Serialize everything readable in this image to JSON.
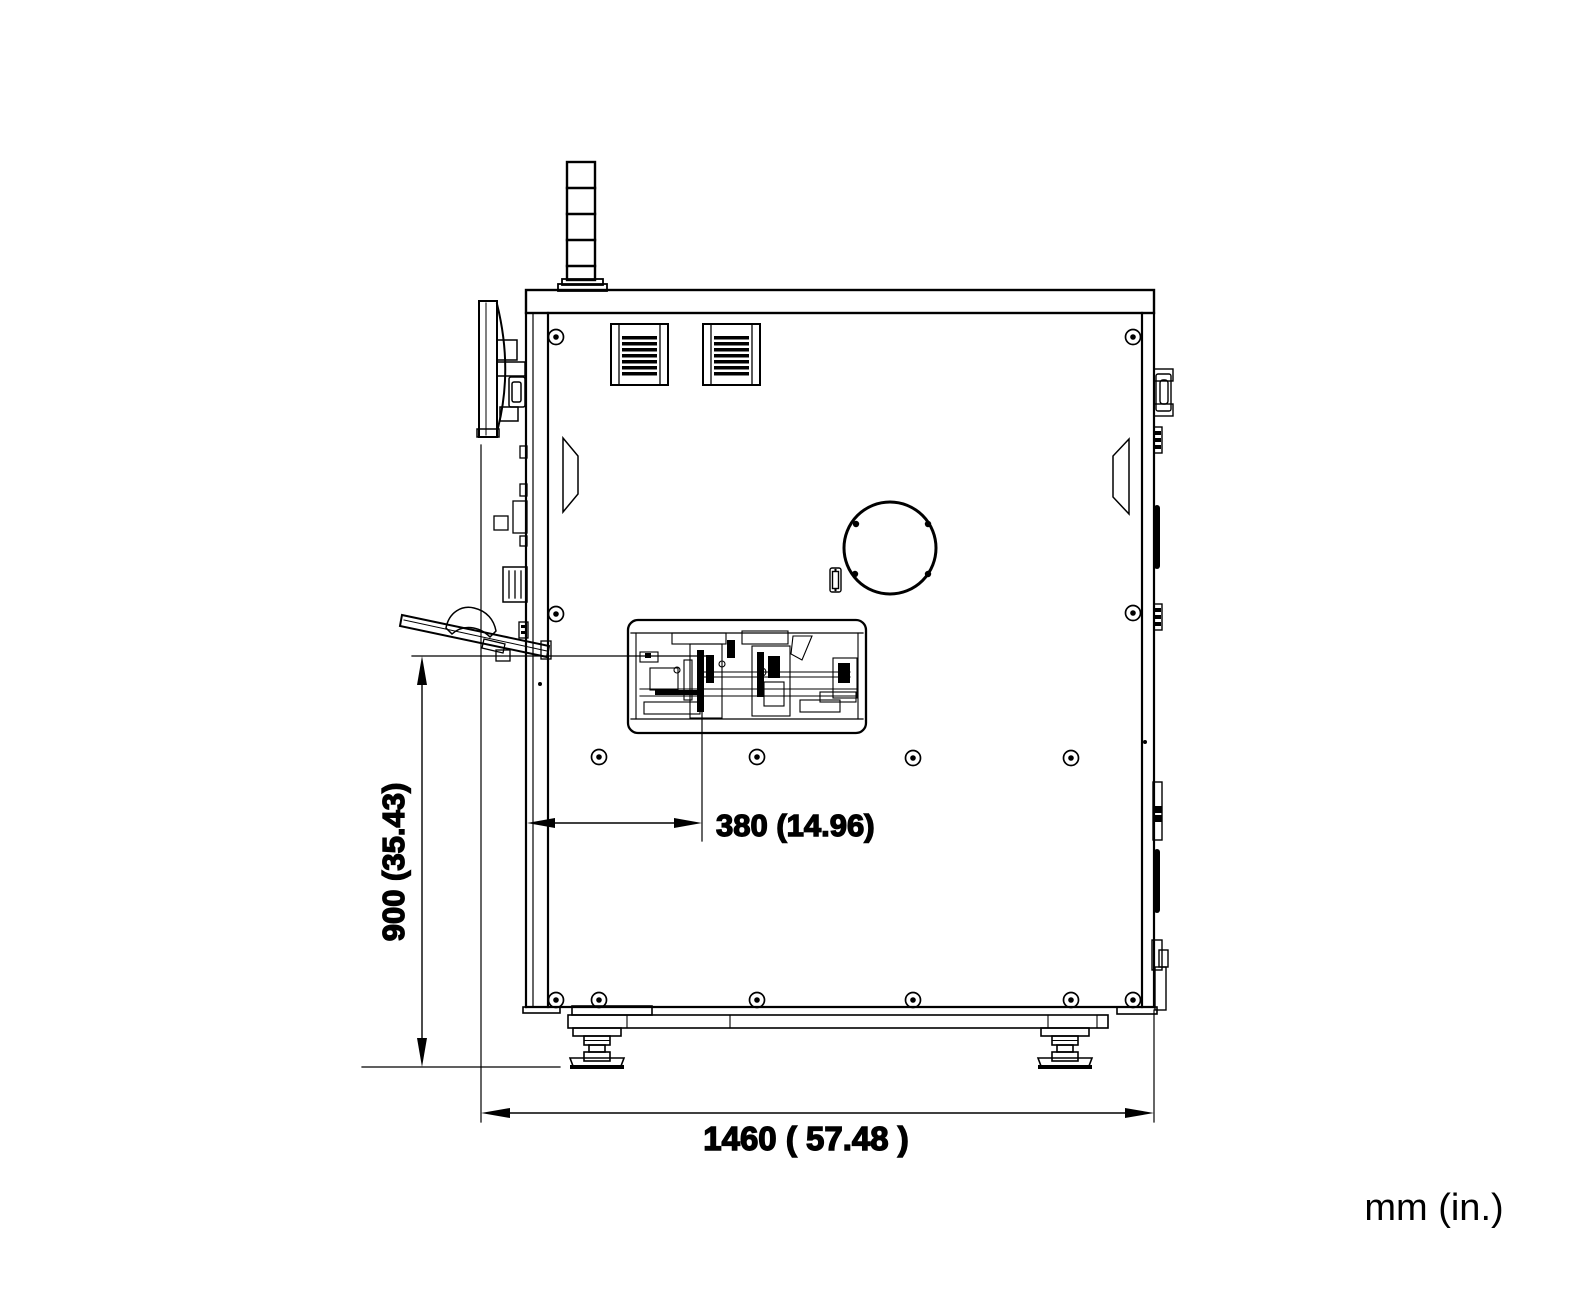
{
  "drawing": {
    "type": "technical-dimension-drawing",
    "view": "machine-side-elevation",
    "units_label": "mm (in.)",
    "dimensions": [
      {
        "id": "work-height",
        "label": "900 (35.43)",
        "mm": 900,
        "inches": 35.43,
        "orientation": "vertical"
      },
      {
        "id": "table-depth-offset",
        "label": "380 (14.96)",
        "mm": 380,
        "inches": 14.96,
        "orientation": "horizontal"
      },
      {
        "id": "overall-depth",
        "label": "1460 ( 57.48 )",
        "mm": 1460,
        "inches": 57.48,
        "orientation": "horizontal"
      }
    ],
    "colors": {
      "line": "#000000",
      "background": "#ffffff"
    }
  }
}
